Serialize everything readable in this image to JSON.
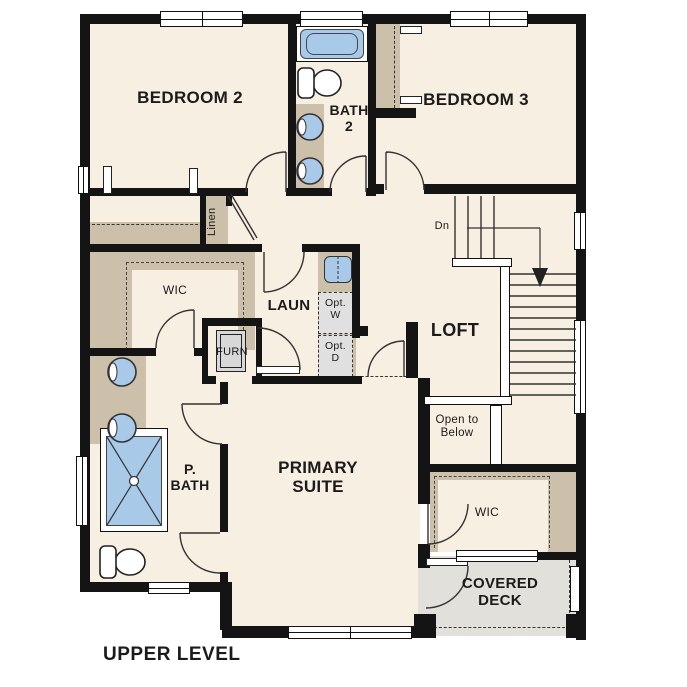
{
  "plan_title": "UPPER LEVEL",
  "colors": {
    "wall": "#141414",
    "floor": "#f7efe2",
    "closet_tan": "#ccc0aa",
    "fixture_blue": "#a9c9e8",
    "deck_gray": "#e2e0db",
    "appliance_gray": "#e0e0e0",
    "line": "#333333"
  },
  "rooms": {
    "bedroom2": {
      "label": "BEDROOM 2"
    },
    "bath2": {
      "line1": "BATH",
      "line2": "2"
    },
    "bedroom3": {
      "label": "BEDROOM 3"
    },
    "loft": {
      "label": "LOFT"
    },
    "laundry": {
      "label": "LAUN"
    },
    "linen": {
      "label": "Linen"
    },
    "wic_left": {
      "label": "WIC"
    },
    "furnace": {
      "label": "FURN"
    },
    "primary_bath": {
      "line1": "P.",
      "line2": "BATH"
    },
    "primary_suite": {
      "line1": "PRIMARY",
      "line2": "SUITE"
    },
    "wic_right": {
      "label": "WIC"
    },
    "covered_deck": {
      "line1": "COVERED",
      "line2": "DECK"
    },
    "open_to_below": {
      "line1": "Open to",
      "line2": "Below"
    }
  },
  "annotations": {
    "stair_direction": "Dn",
    "opt_washer": {
      "line1": "Opt.",
      "line2": "W"
    },
    "opt_dryer": {
      "line1": "Opt.",
      "line2": "D"
    }
  }
}
